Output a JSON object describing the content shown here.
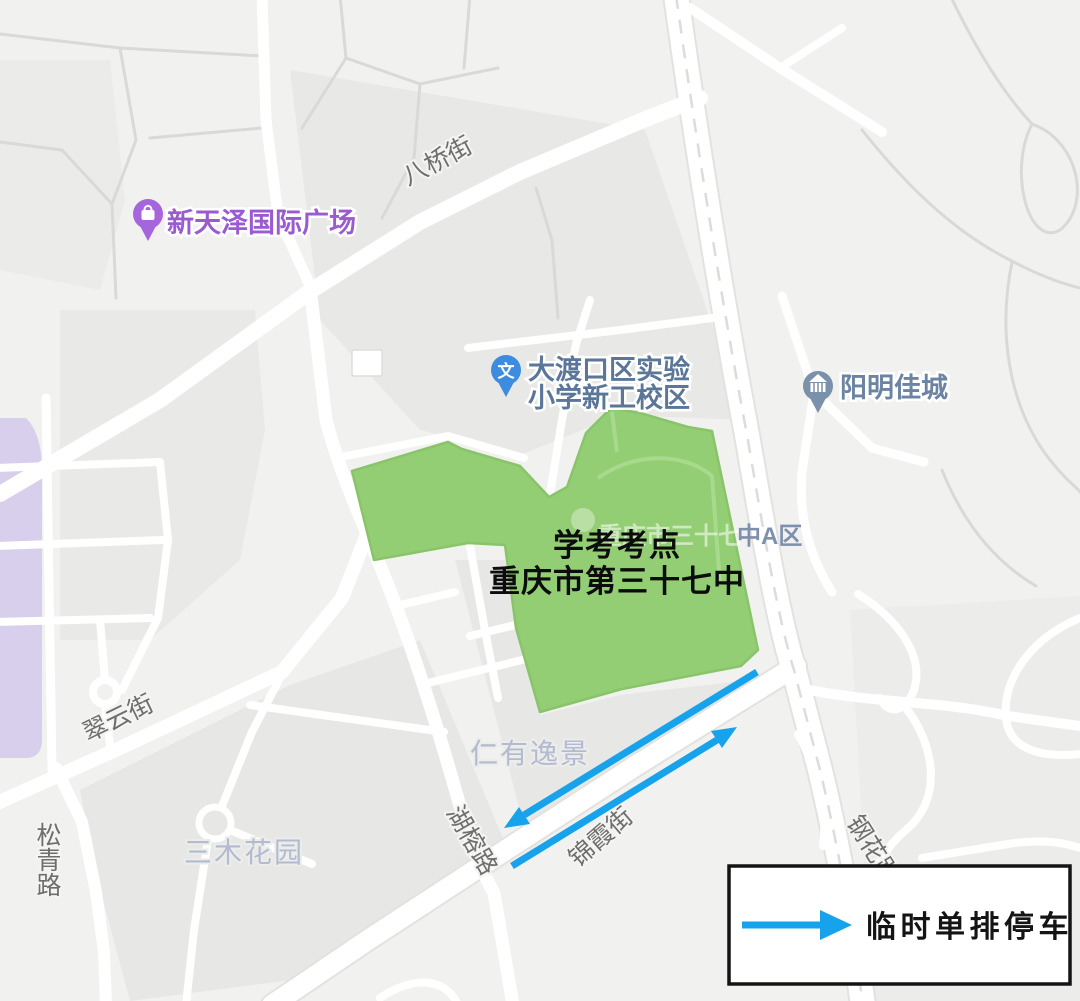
{
  "map": {
    "exam_site": {
      "line1": "学考考点",
      "line2": "重庆市第三十七中"
    },
    "campus_base_label": {
      "faint_part": "重庆市三十七",
      "visible_part": "中A区"
    },
    "pois": {
      "xintianze": {
        "label": "新天泽国际广场"
      },
      "primary_school": {
        "label_line1": "大渡口区实验",
        "label_line2": "小学新工校区",
        "icon_glyph": "文"
      },
      "yangming": {
        "label": "阳明佳城"
      }
    },
    "streets": {
      "baqiao": "八桥街",
      "cuiyun": "翠云街",
      "songqing": "松青路",
      "hurong": "湖榕路",
      "jinxia": "锦霞街",
      "ganghua": "钢花路"
    },
    "areas": {
      "renyou": "仁有逸景",
      "sanmu": "三木花园"
    }
  },
  "legend": {
    "label": "临时单排停车"
  },
  "colors": {
    "campus_green": "#94ce74",
    "campus_green_edge": "#89c46a",
    "arrow_blue": "#17a3ec",
    "poi_purple_pin": "#a566dd",
    "poi_purple_text": "#9a5ad0",
    "poi_blue_pin": "#3d8ce0",
    "poi_blue_text": "#5a7699",
    "poi_slate_pin": "#7b90aa",
    "poi_slate_text": "#6b84a3",
    "campus_label_gray": "#7e90ad"
  }
}
